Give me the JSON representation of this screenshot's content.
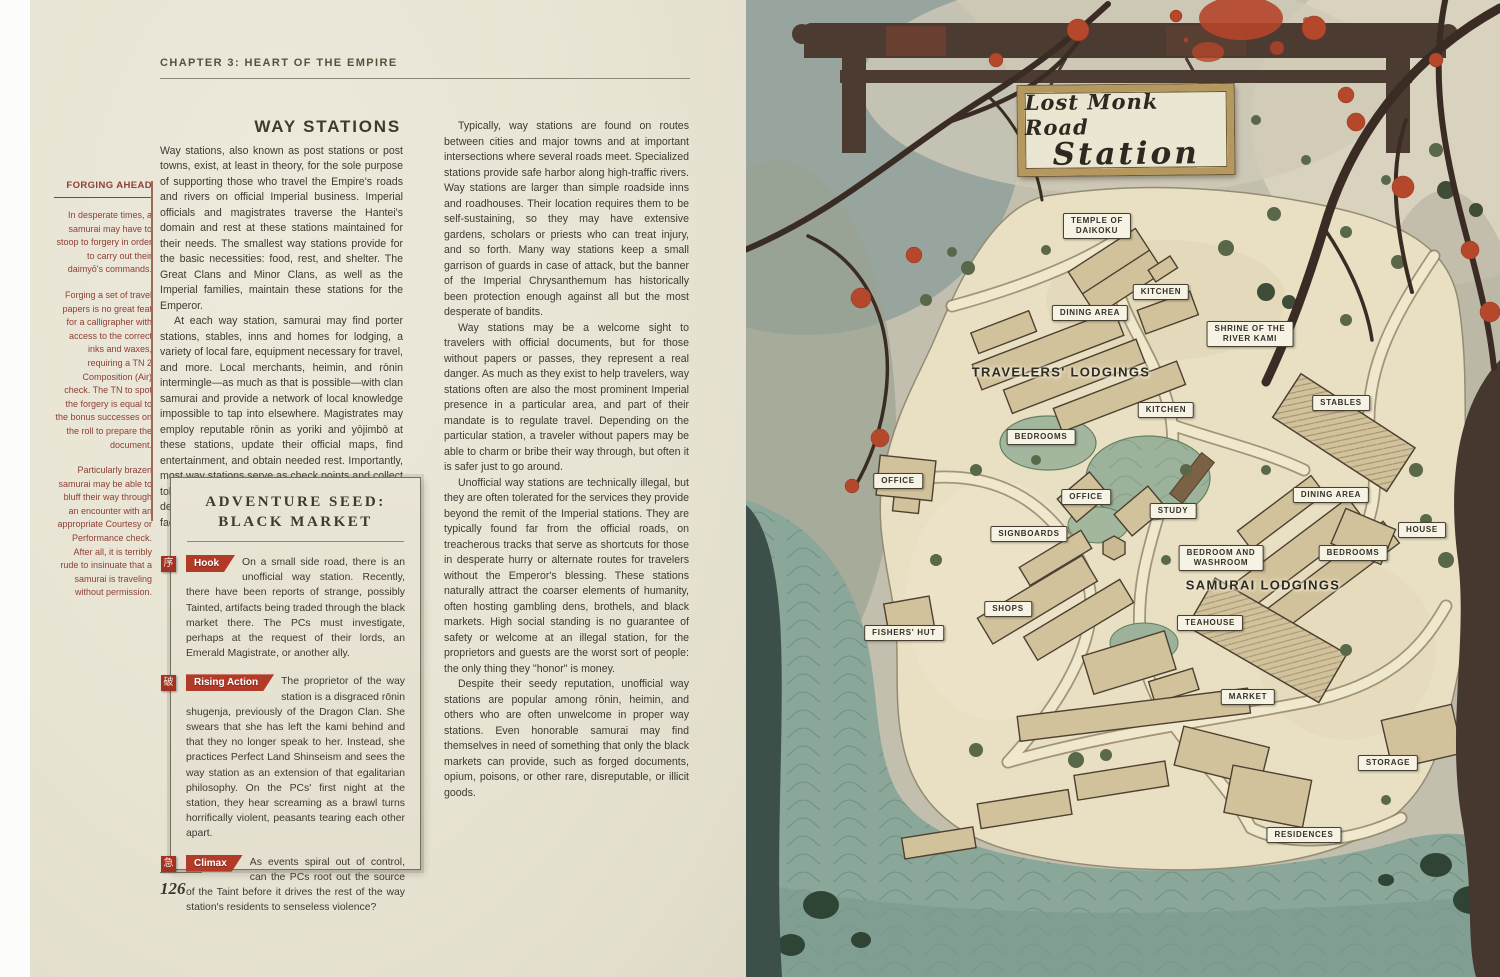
{
  "left_page": {
    "chapter_header": "CHAPTER 3: HEART OF THE EMPIRE",
    "page_number": "126",
    "sidebar": {
      "title": "FORGING AHEAD",
      "paragraphs": [
        "In desperate times, a samurai may have to stoop to forgery in order to carry out their daimyō's commands.",
        "Forging a set of travel papers is no great feat for a calligrapher with access to the correct inks and waxes, requiring a TN 2 Composition (Air) check. The TN to spot the forgery is equal to the bonus successes on the roll to prepare the document.",
        "Particularly brazen samurai may be able to bluff their way through an encounter with an appropriate Courtesy or Performance check. After all, it is terribly rude to insinuate that a samurai is traveling without permission."
      ]
    },
    "main": {
      "heading": "WAY STATIONS",
      "col1_paragraphs": [
        "Way stations, also known as post stations or post towns, exist, at least in theory, for the sole purpose of supporting those who travel the Empire's roads and rivers on official Imperial business. Imperial officials and magistrates traverse the Hantei's domain and rest at these stations maintained for their needs. The smallest way stations provide for the basic necessities: food, rest, and shelter. The Great Clans and Minor Clans, as well as the Imperial families, maintain these stations for the Emperor.",
        "At each way station, samurai may find porter stations, stables, inns and homes for lodging, a variety of local fare, equipment necessary for travel, and more. Local merchants, heimin, and rōnin intermingle—as much as that is possible—with clan samurai and provide a network of local knowledge impossible to tap into elsewhere. Magistrates may employ reputable rōnin as yoriki and yōjimbō at these stations, update their official maps, find entertainment, and obtain needed rest. Importantly, most way stations serve as check points and collect tolls—whether formally, or due to the proprietor's desire to keep out the riffraff and maintain their facilities."
      ],
      "col2_paragraphs": [
        "Typically, way stations are found on routes between cities and major towns and at important intersections where several roads meet. Specialized stations provide safe harbor along high-traffic rivers. Way stations are larger than simple roadside inns and roadhouses. Their location requires them to be self-sustaining, so they may have extensive gardens, scholars or priests who can treat injury, and so forth. Many way stations keep a small garrison of guards in case of attack, but the banner of the Imperial Chrysanthemum has historically been protection enough against all but the most desperate of bandits.",
        "Way stations may be a welcome sight to travelers with official documents, but for those without papers or passes, they represent a real danger. As much as they exist to help travelers, way stations often are also the most prominent Imperial presence in a particular area, and part of their mandate is to regulate travel. Depending on the particular station, a traveler without papers may be able to charm or bribe their way through, but often it is safer just to go around.",
        "Unofficial way stations are technically illegal, but they are often tolerated for the services they provide beyond the remit of the Imperial stations. They are typically found far from the official roads, on treacherous tracks that serve as shortcuts for those in desperate hurry or alternate routes for travelers without the Emperor's blessing. These stations naturally attract the coarser elements of humanity, often hosting gambling dens, brothels, and black markets. High social standing is no guarantee of safety or welcome at an illegal station, for the proprietors and guests are the worst sort of people: the only thing they \"honor\" is money.",
        "Despite their seedy reputation, unofficial way stations are popular among rōnin, heimin, and others who are often unwelcome in proper way stations. Even honorable samurai may find themselves in need of something that only the black markets can provide, such as forged documents, opium, poisons, or other rare, disreputable, or illicit goods."
      ]
    },
    "adventure_seed": {
      "title_line1": "ADVENTURE SEED:",
      "title_line2": "BLACK MARKET",
      "entries": [
        {
          "tag": "Hook",
          "icon": "序",
          "text": "On a small side road, there is an unofficial way station. Recently, there have been reports of strange, possibly Tainted, artifacts being traded through the black market there. The PCs must investigate, perhaps at the request of their lords, an Emerald Magistrate, or another ally."
        },
        {
          "tag": "Rising Action",
          "icon": "破",
          "text": "The proprietor of the way station is a disgraced rōnin shugenja, previously of the Dragon Clan. She swears that she has left the kami behind and that they no longer speak to her. Instead, she practices Perfect Land Shinseism and sees the way station as an extension of that egalitarian philosophy. On the PCs' first night at the station, they hear screaming as a brawl turns horrifically violent, peasants tearing each other apart."
        },
        {
          "tag": "Climax",
          "icon": "急",
          "text": "As events spiral out of control, can the PCs root out the source of the Taint before it drives the rest of the way station's residents to senseless violence?"
        }
      ]
    }
  },
  "right_page": {
    "sign": {
      "line1": "Lost Monk Road",
      "line2": "Station"
    },
    "area_labels": [
      {
        "text": "TEMPLE OF\nDAIKOKU",
        "x": 351,
        "y": 226
      },
      {
        "text": "KITCHEN",
        "x": 415,
        "y": 292
      },
      {
        "text": "DINING AREA",
        "x": 344,
        "y": 313
      },
      {
        "text": "SHRINE OF THE\nRIVER KAMI",
        "x": 504,
        "y": 334
      },
      {
        "text": "KITCHEN",
        "x": 420,
        "y": 410
      },
      {
        "text": "BEDROOMS",
        "x": 295,
        "y": 437
      },
      {
        "text": "STABLES",
        "x": 595,
        "y": 403
      },
      {
        "text": "OFFICE",
        "x": 152,
        "y": 481
      },
      {
        "text": "OFFICE",
        "x": 340,
        "y": 497
      },
      {
        "text": "STUDY",
        "x": 427,
        "y": 511
      },
      {
        "text": "DINING AREA",
        "x": 585,
        "y": 495
      },
      {
        "text": "HOUSE",
        "x": 676,
        "y": 530
      },
      {
        "text": "SIGNBOARDS",
        "x": 283,
        "y": 534
      },
      {
        "text": "BEDROOM AND\nWASHROOM",
        "x": 475,
        "y": 558
      },
      {
        "text": "BEDROOMS",
        "x": 607,
        "y": 553
      },
      {
        "text": "SHOPS",
        "x": 262,
        "y": 609
      },
      {
        "text": "FISHERS' HUT",
        "x": 158,
        "y": 633
      },
      {
        "text": "TEAHOUSE",
        "x": 464,
        "y": 623
      },
      {
        "text": "MARKET",
        "x": 502,
        "y": 697
      },
      {
        "text": "STORAGE",
        "x": 642,
        "y": 763
      },
      {
        "text": "RESIDENCES",
        "x": 558,
        "y": 835
      }
    ],
    "zone_labels": [
      {
        "text": "TRAVELERS' LODGINGS",
        "x": 315,
        "y": 372
      },
      {
        "text": "SAMURAI LODGINGS",
        "x": 517,
        "y": 585
      }
    ]
  },
  "colors": {
    "parchment_page": "#e8e4d4",
    "map_parchment": "#e9dfc3",
    "water": "#8aa79a",
    "accent_red": "#b23b28",
    "sidebar_red": "#8d4034",
    "ink": "#3c3a31"
  }
}
